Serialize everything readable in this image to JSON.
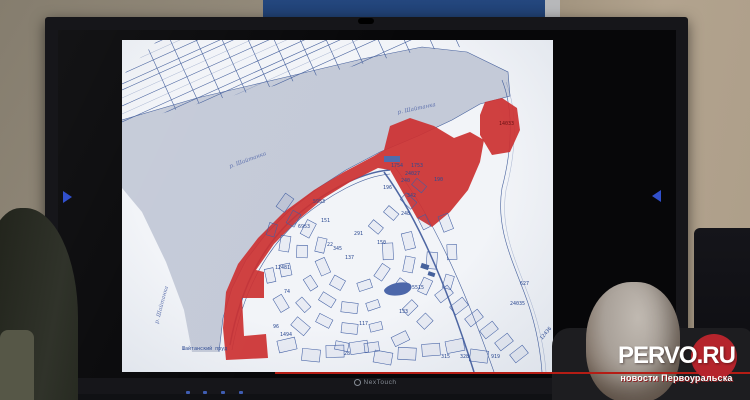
{
  "display": {
    "brand": "NexTouch"
  },
  "watermark": {
    "title_white": "PERVO",
    "title_red": ".RU",
    "subtitle": "новости Первоуральска",
    "accent_color": "#b5242c"
  },
  "map": {
    "colors": {
      "page": "#f2f4f8",
      "lines": "#3f5ea6",
      "water": "#c4cad9",
      "highlight_red": "#d23030"
    },
    "water_labels": [
      {
        "t": "р. Шайтанка",
        "x": 108,
        "y": 128,
        "r": -20
      },
      {
        "t": "р. Шайтанка",
        "x": 276,
        "y": 74,
        "r": -12
      },
      {
        "t": "р. Шайтанка",
        "x": 36,
        "y": 284,
        "r": -75
      }
    ],
    "place_label": {
      "t": "Шайтанский пруд",
      "x": 60,
      "y": 310
    },
    "parcel_labels": [
      {
        "t": "5953",
        "x": 191,
        "y": 163
      },
      {
        "t": "6953",
        "x": 176,
        "y": 188
      },
      {
        "t": "1754",
        "x": 269,
        "y": 127
      },
      {
        "t": "1753",
        "x": 289,
        "y": 127
      },
      {
        "t": "24027",
        "x": 283,
        "y": 135
      },
      {
        "t": "240",
        "x": 279,
        "y": 142
      },
      {
        "t": "190",
        "x": 312,
        "y": 141
      },
      {
        "t": "196",
        "x": 261,
        "y": 149
      },
      {
        "t": "342",
        "x": 285,
        "y": 157
      },
      {
        "t": "248",
        "x": 279,
        "y": 175
      },
      {
        "t": "151",
        "x": 199,
        "y": 182
      },
      {
        "t": "291",
        "x": 232,
        "y": 195
      },
      {
        "t": "22",
        "x": 205,
        "y": 206
      },
      {
        "t": "345",
        "x": 211,
        "y": 210
      },
      {
        "t": "137",
        "x": 223,
        "y": 219
      },
      {
        "t": "150",
        "x": 255,
        "y": 204
      },
      {
        "t": "5515",
        "x": 290,
        "y": 249
      },
      {
        "t": "133",
        "x": 277,
        "y": 273
      },
      {
        "t": "117",
        "x": 237,
        "y": 285
      },
      {
        "t": "28",
        "x": 222,
        "y": 315
      },
      {
        "t": "315",
        "x": 319,
        "y": 318
      },
      {
        "t": "328",
        "x": 338,
        "y": 318
      },
      {
        "t": "919",
        "x": 369,
        "y": 318
      },
      {
        "t": "627",
        "x": 398,
        "y": 245
      },
      {
        "t": "24035",
        "x": 388,
        "y": 265
      },
      {
        "t": "12436",
        "x": 420,
        "y": 300,
        "r": -50
      },
      {
        "t": "12481",
        "x": 153,
        "y": 229
      },
      {
        "t": "74",
        "x": 162,
        "y": 253
      },
      {
        "t": "96",
        "x": 151,
        "y": 288
      },
      {
        "t": "1494",
        "x": 158,
        "y": 296
      },
      {
        "t": "14033",
        "x": 377,
        "y": 85,
        "c": "red"
      }
    ]
  }
}
